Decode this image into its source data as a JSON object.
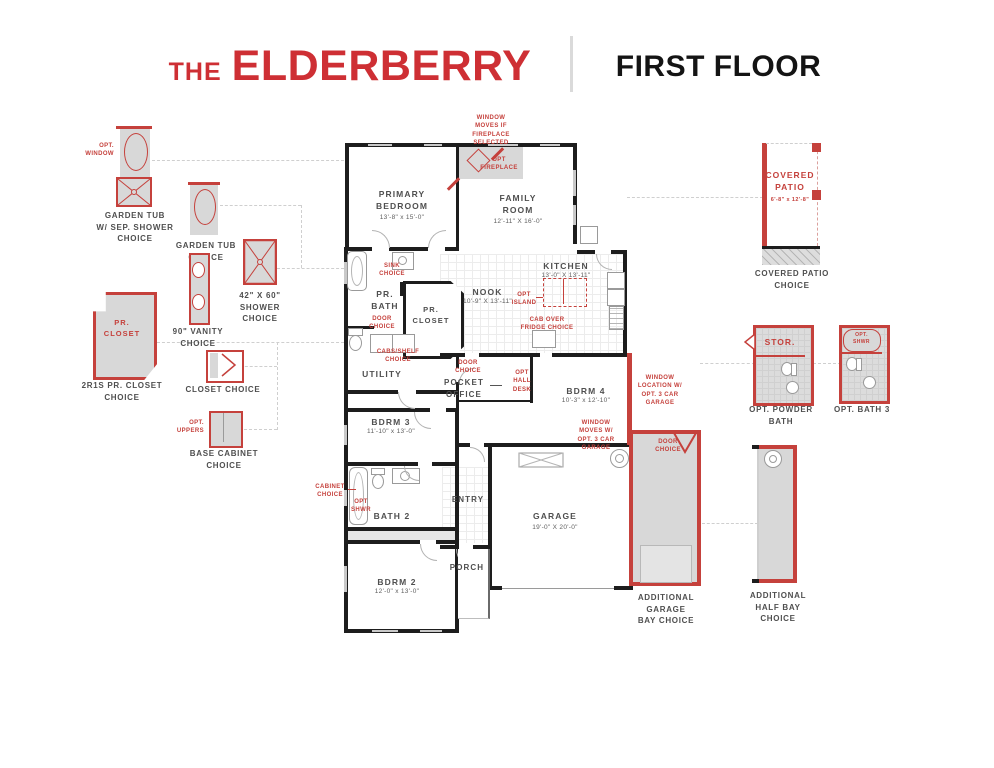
{
  "header": {
    "brand_prefix": "THE",
    "brand_name": "ELDERBERRY",
    "floor_title": "FIRST FLOOR"
  },
  "left_options": [
    {
      "annotation": "OPT.\nWINDOW",
      "label": "GARDEN TUB\nW/ SEP. SHOWER\nCHOICE"
    },
    {
      "label": "GARDEN TUB\nCHOICE"
    },
    {
      "label": "42\" X 60\"\nSHOWER\nCHOICE"
    },
    {
      "label": "90\" VANITY\nCHOICE"
    },
    {
      "room_text": "PR.\nCLOSET",
      "label": "2R1S PR. CLOSET\nCHOICE"
    },
    {
      "label": "CLOSET CHOICE"
    },
    {
      "annotation": "OPT.\nUPPERS",
      "label": "BASE CABINET\nCHOICE"
    }
  ],
  "rooms": {
    "primary_bedroom": {
      "name": "PRIMARY\nBEDROOM",
      "dims": "13'-8\" x 15'-0\""
    },
    "family_room": {
      "name": "FAMILY\nROOM",
      "dims": "12'-11\" X 16'-0\""
    },
    "kitchen": {
      "name": "KITCHEN",
      "dims": "13'-0\" X 13'-11\""
    },
    "nook": {
      "name": "NOOK",
      "dims": "10'-9\" X 13'-11\""
    },
    "pr_bath": {
      "name": "PR.\nBATH"
    },
    "pr_closet": {
      "name": "PR.\nCLOSET"
    },
    "utility": {
      "name": "UTILITY"
    },
    "pocket_office": {
      "name": "POCKET\nOFFICE"
    },
    "bdrm4": {
      "name": "BDRM 4",
      "dims": "10'-3\" x 12'-10\""
    },
    "bdrm3": {
      "name": "BDRM 3",
      "dims": "11'-10\" x 13'-0\""
    },
    "bath2": {
      "name": "BATH 2"
    },
    "bdrm2": {
      "name": "BDRM 2",
      "dims": "12'-0\" x 13'-0\""
    },
    "entry": {
      "name": "ENTRY"
    },
    "porch": {
      "name": "PORCH"
    },
    "garage": {
      "name": "GARAGE",
      "dims": "19'-0\" X 20'-0\""
    }
  },
  "callouts": {
    "window_moves_fireplace": "WINDOW\nMOVES IF\nFIREPLACE\nSELECTED",
    "opt_fireplace": "OPT\nFIREPLACE",
    "sink_choice": "SINK\nCHOICE",
    "door_choice_bath": "DOOR\nCHOICE",
    "cabs_shelf_choice": "CABS/SHELF\nCHOICE",
    "opt_island": "OPT\nISLAND",
    "cab_over_fridge": "CAB OVER\nFRIDGE CHOICE",
    "door_choice_office": "DOOR\nCHOICE",
    "opt_hall_desk": "OPT\nHALL\nDESK",
    "window_location_garage": "WINDOW\nLOCATION W/\nOPT. 3 CAR\nGARAGE",
    "window_moves_garage": "WINDOW\nMOVES W/\nOPT. 3 CAR\nGARAGE",
    "cabinet_choice": "CABINET\nCHOICE",
    "opt_shwr": "OPT\nSHWR"
  },
  "right_options": {
    "covered_patio": {
      "room_text": "COVERED\nPATIO",
      "dims": "6'-8\" x 12'-8\"",
      "label": "COVERED PATIO\nCHOICE"
    },
    "powder_bath": {
      "room_text": "STOR.",
      "label": "OPT. POWDER\nBATH"
    },
    "bath3": {
      "room_text": "OPT.\nSHWR",
      "label": "OPT. BATH 3"
    },
    "additional_garage_bay": {
      "door_text": "DOOR\nCHOICE",
      "label": "ADDITIONAL\nGARAGE\nBAY CHOICE"
    },
    "additional_half_bay": {
      "label": "ADDITIONAL\nHALF BAY\nCHOICE"
    }
  },
  "colors": {
    "accent_red": "#c5413c",
    "wall_black": "#1d1d1d",
    "fill_gray": "#d8d8d8"
  }
}
